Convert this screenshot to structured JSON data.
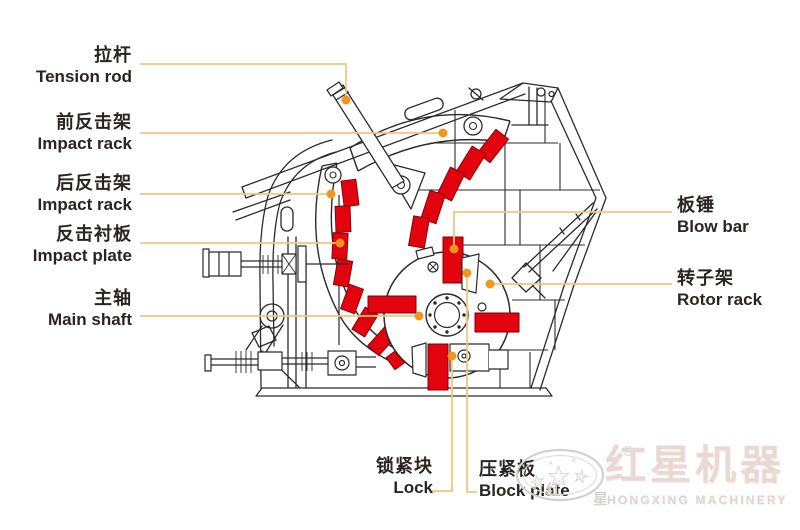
{
  "labels": {
    "tension_rod": {
      "cn": "拉杆",
      "en": "Tension rod"
    },
    "impact_rack_front": {
      "cn": "前反击架",
      "en": "Impact rack"
    },
    "impact_rack_rear": {
      "cn": "后反击架",
      "en": "Impact rack"
    },
    "impact_plate": {
      "cn": "反击衬板",
      "en": "Impact plate"
    },
    "main_shaft": {
      "cn": "主轴",
      "en": "Main shaft"
    },
    "blow_bar": {
      "cn": "板锤",
      "en": "Blow bar"
    },
    "rotor_rack": {
      "cn": "转子架",
      "en": "Rotor rack"
    },
    "lock": {
      "cn": "锁紧块",
      "en": "Lock"
    },
    "block_plate": {
      "cn": "压紧板",
      "en": "Block plate"
    }
  },
  "logo": {
    "brand_cn": "红星机器",
    "brand_en": "HONGXING MACHINERY",
    "emblem_char_1": "红",
    "emblem_char_2": "星",
    "registered": "R",
    "star": "★",
    "sparkle": "×"
  },
  "colors": {
    "part_red": "#e2030f",
    "line_art": "#2b2b2b",
    "leader_line": "#f2c67e",
    "leader_dot": "#f0961e",
    "label_text": "#2a2523",
    "logo_red": "#ead8d2",
    "logo_gray": "#d3d1d0"
  }
}
